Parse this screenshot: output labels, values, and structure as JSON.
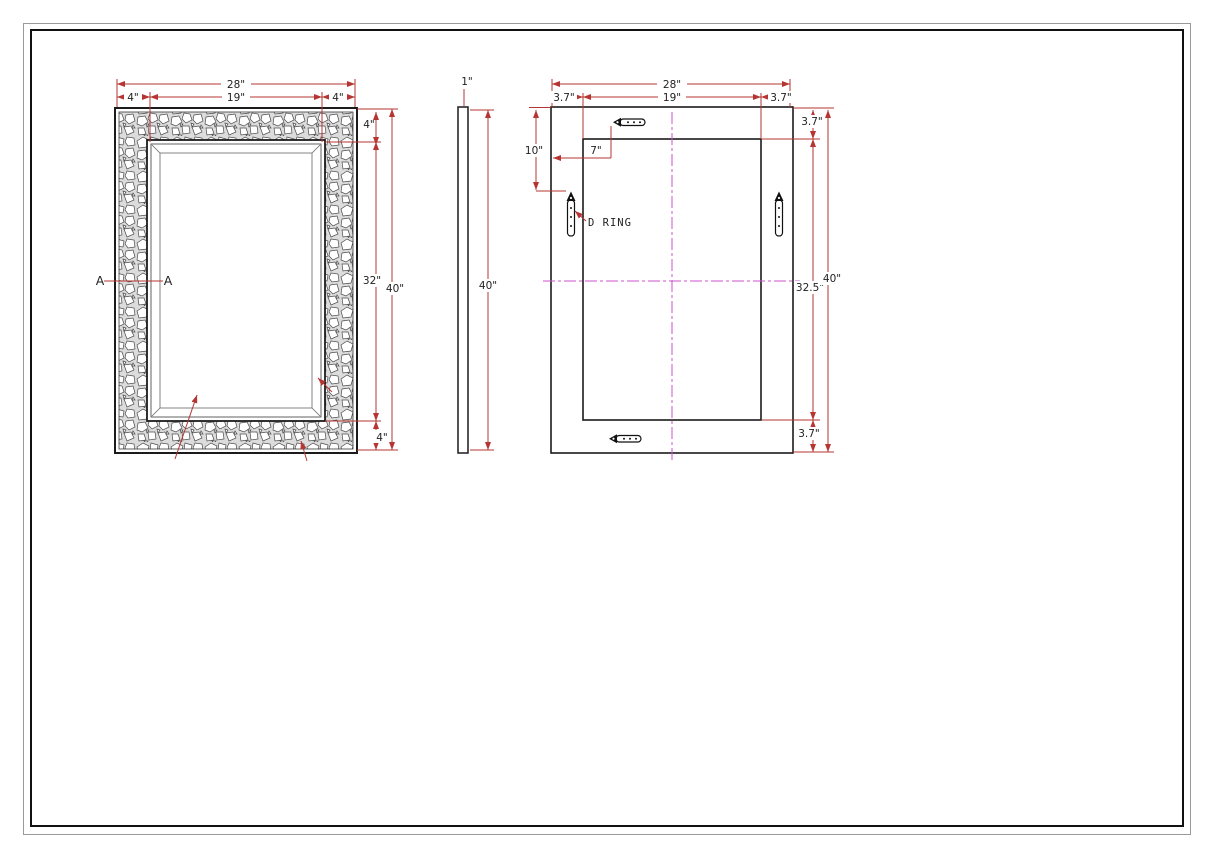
{
  "colors": {
    "dimension": "#b63431",
    "centerline": "#cf52cf",
    "line": "#1b1b1b",
    "label": "#222222"
  },
  "front_view": {
    "dims": {
      "overall_width": "28\"",
      "opening_width": "19\"",
      "frame_left": "4\"",
      "frame_right": "4\"",
      "frame_top": "4\"",
      "opening_height": "32\"",
      "overall_height": "40\"",
      "frame_bottom": "4\""
    },
    "section": {
      "left": "A",
      "right": "A"
    }
  },
  "side_view": {
    "dims": {
      "thickness": "1\"",
      "overall_height": "40\""
    }
  },
  "back_view": {
    "dims": {
      "overall_width": "28\"",
      "opening_width": "19\"",
      "margin_left": "3.7\"",
      "margin_right": "3.7\"",
      "margin_top": "3.7\"",
      "opening_height": "32.5\"",
      "overall_height": "40\"",
      "margin_bottom": "3.7\"",
      "dring_from_top": "10\"",
      "dring_from_left": "7\""
    },
    "labels": {
      "d_ring": "D RING"
    }
  }
}
